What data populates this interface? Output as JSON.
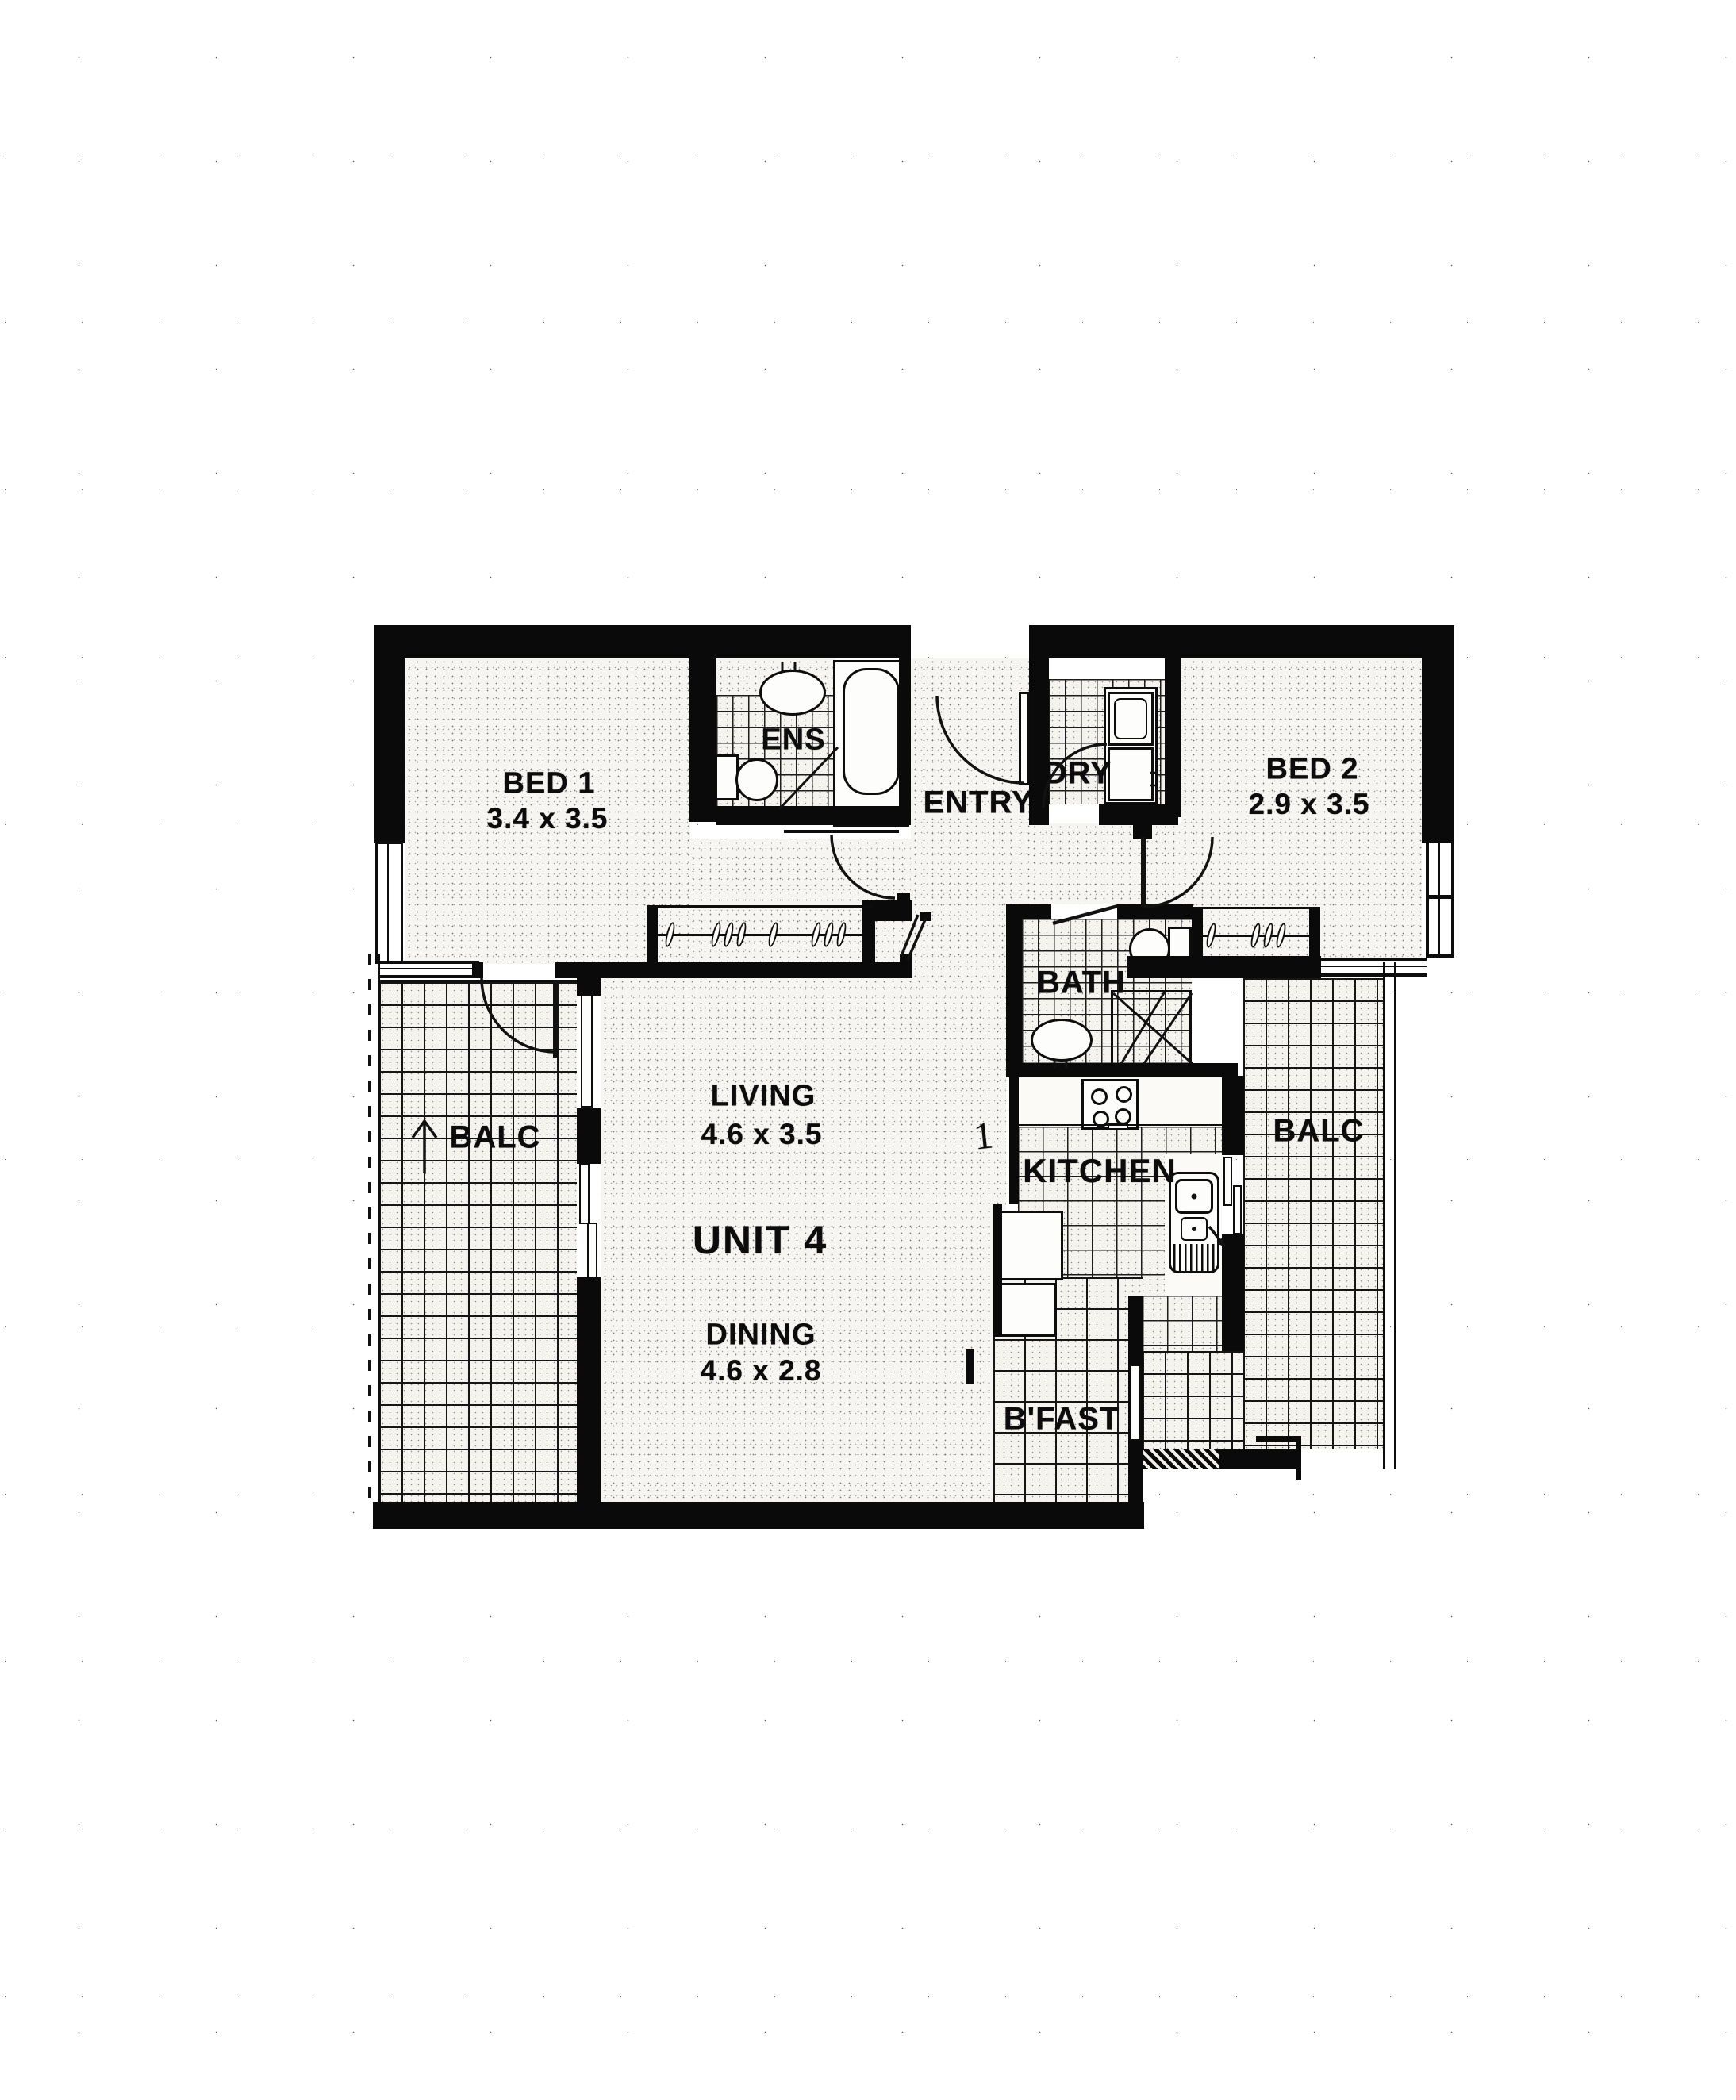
{
  "plan": {
    "unit_label": "UNIT 4",
    "stray_mark": "1",
    "rooms": {
      "bed1": {
        "label": "BED 1",
        "dims": "3.4 x 3.5"
      },
      "ens": {
        "label": "ENS"
      },
      "entry": {
        "label": "ENTRY"
      },
      "ldry": {
        "label": "LDRY"
      },
      "bed2": {
        "label": "BED 2",
        "dims": "2.9 x 3.5"
      },
      "bath": {
        "label": "BATH"
      },
      "living": {
        "label": "LIVING",
        "dims": "4.6 x 3.5"
      },
      "dining": {
        "label": "DINING",
        "dims": "4.6 x 2.8"
      },
      "kitchen": {
        "label": "KITCHEN"
      },
      "bfast": {
        "label": "B'FAST"
      },
      "balc_left": {
        "label": "BALC"
      },
      "balc_right": {
        "label": "BALC"
      }
    },
    "colors": {
      "wall": "#0a0a0a",
      "paper": "#ffffff"
    }
  }
}
